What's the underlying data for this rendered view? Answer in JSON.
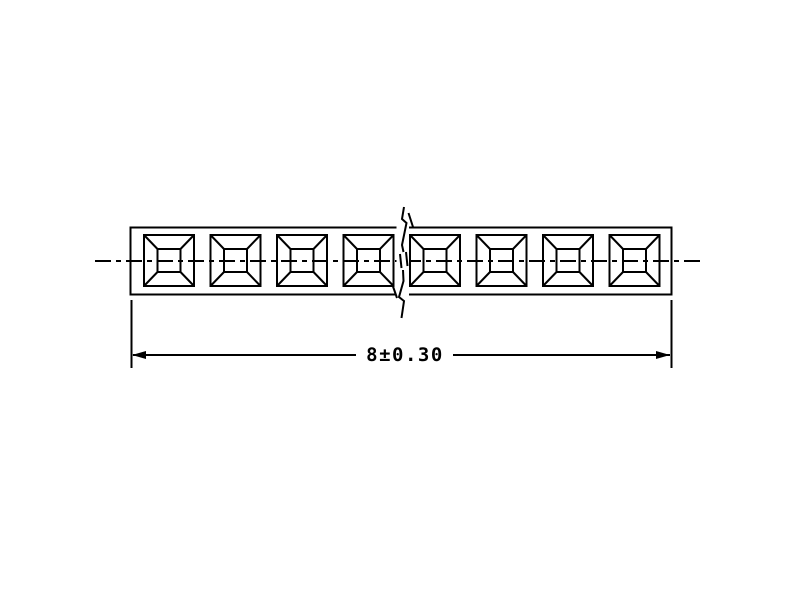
{
  "drawing": {
    "title": "connector-strip-front-view",
    "cavity_count": 8,
    "dimension": {
      "label": "8±0.30",
      "nominal": "8",
      "tolerance": "±0.30"
    },
    "colors": {
      "line": "#000000",
      "background": "#ffffff"
    }
  }
}
